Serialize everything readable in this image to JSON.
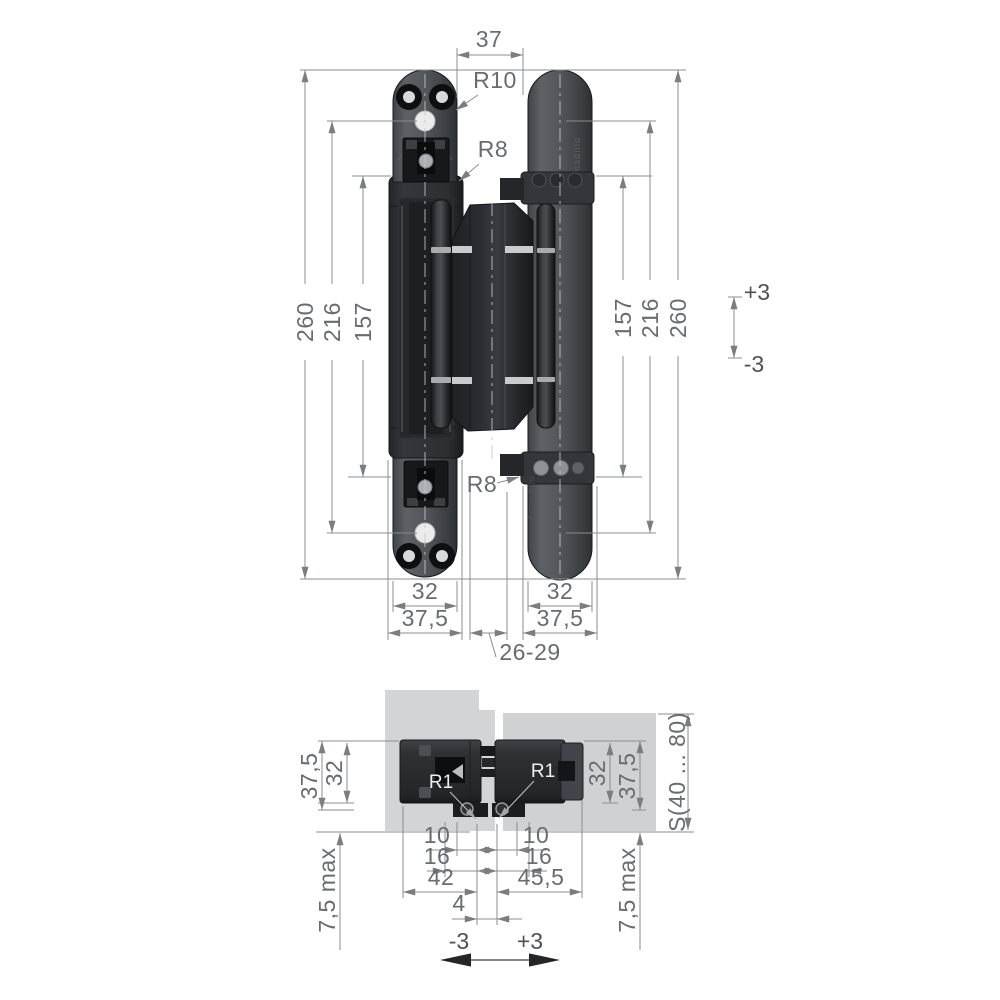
{
  "brand": {
    "engraving": "Armadillo"
  },
  "front_view": {
    "width_top": "37",
    "r_top": "R10",
    "r_shoulder_top": "R8",
    "r_shoulder_bottom": "R8",
    "left_dims": {
      "overall": "260",
      "screws": "216",
      "arms": "157"
    },
    "right_dims": {
      "arms": "157",
      "screws": "216",
      "overall": "260"
    },
    "vertical_adjust": {
      "up": "+3",
      "down": "-3"
    },
    "left_plate": {
      "width": "32",
      "flange": "37,5"
    },
    "right_plate": {
      "width": "32",
      "flange": "37,5"
    },
    "gap": "26-29"
  },
  "section_view": {
    "left": {
      "depth": "32",
      "flange": "37,5",
      "protrusion": "7,5 max"
    },
    "right": {
      "depth": "32",
      "flange": "37,5",
      "protrusion": "7,5 max"
    },
    "door_thickness": "S(40 ... 80)",
    "r_left": "R1",
    "r_right": "R1",
    "left_offsets": {
      "d10": "10",
      "d16": "16",
      "d42": "42"
    },
    "right_offsets": {
      "d10": "10",
      "d16": "16",
      "d45": "45,5"
    },
    "axis_gap": "4",
    "horizontal_adjust": {
      "left": "-3",
      "right": "+3"
    }
  }
}
